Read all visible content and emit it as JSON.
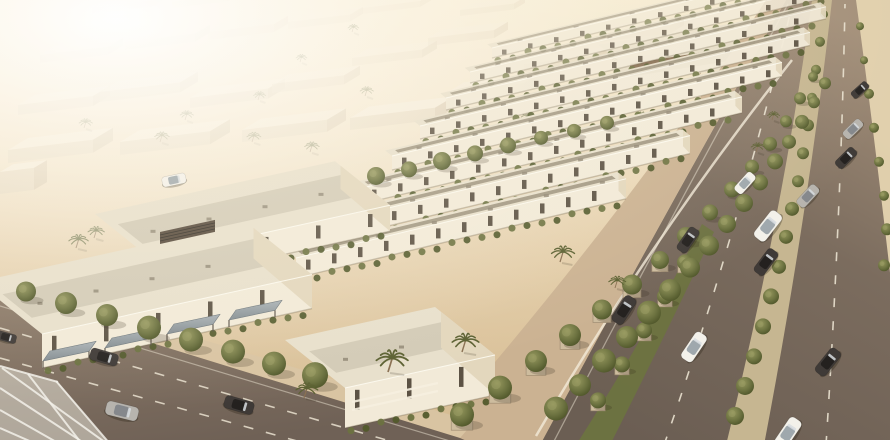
{
  "canvas": {
    "w": 890,
    "h": 440
  },
  "palette": {
    "road_dash": "#eae2d0",
    "edge_line": "#e9e1d0",
    "car_white": "#f3f1ea",
    "car_silver": "#b7b4ae",
    "car_dark": "#3f3a37",
    "cabin_white": "#9fa8ad",
    "cabin_silver": "#85888c",
    "cabin_dark": "#24211f",
    "wall": "#f2ead8",
    "end_wall": "#e3d7bd",
    "roof_out": "#e8e0cc",
    "roof_in_row": "#9f9580",
    "roof_in_villa": "#d2c9b5",
    "window": "#4b4134",
    "wood": "#8a6e4c",
    "green_a": "#6c7240",
    "green_b": "#525a2c",
    "planter": "#cdbc9e",
    "planter_edge": "#9f8c72",
    "trunk": "#8a7052",
    "palm": "#5c6132",
    "post": "#5f564c",
    "median_sand": "#c6b691",
    "median_green": "#6d7340",
    "sidewalk_blvd": "#cbb292",
    "sidewalk_street": "#d9c4a2",
    "verge": "#e5d4b0",
    "canopy_fill": "#eceade",
    "canopy_frame": "#f3f1ea",
    "stripe": "#7a5f43",
    "louver": "#55483a",
    "bg_roof": "#efe6d2",
    "bg_wall": "#d8c8aa",
    "bg_side": "#c7b494",
    "club_roof": "#ece2cc",
    "club_wall": "#e6dcc6",
    "club_side": "#d6c7a8"
  },
  "background": {
    "boxes": [
      [
        8,
        150,
        85,
        40,
        13,
        0.95
      ],
      [
        120,
        142,
        90,
        40,
        13,
        0.95
      ],
      [
        242,
        130,
        85,
        38,
        12,
        0.9
      ],
      [
        350,
        118,
        85,
        38,
        12,
        0.88
      ],
      [
        18,
        105,
        75,
        34,
        10,
        0.8
      ],
      [
        100,
        92,
        80,
        36,
        10,
        0.75
      ],
      [
        190,
        98,
        78,
        34,
        10,
        0.78
      ],
      [
        272,
        84,
        72,
        32,
        9,
        0.7
      ],
      [
        40,
        55,
        68,
        30,
        8,
        0.5
      ],
      [
        125,
        42,
        70,
        30,
        8,
        0.45
      ],
      [
        208,
        32,
        66,
        28,
        8,
        0.42
      ],
      [
        288,
        22,
        62,
        26,
        7,
        0.38
      ],
      [
        92,
        8,
        60,
        24,
        6,
        0.3
      ],
      [
        172,
        2,
        56,
        22,
        6,
        0.28
      ],
      [
        352,
        58,
        70,
        30,
        8,
        0.5
      ],
      [
        428,
        38,
        66,
        28,
        8,
        0.45
      ],
      [
        362,
        8,
        58,
        24,
        6,
        0.32
      ],
      [
        448,
        92,
        76,
        32,
        9,
        0.62
      ],
      [
        524,
        64,
        70,
        30,
        8,
        0.55
      ],
      [
        600,
        34,
        70,
        28,
        8,
        0.5
      ],
      [
        0,
        172,
        34,
        26,
        22,
        0.95
      ],
      [
        460,
        10,
        54,
        22,
        6,
        0.3
      ],
      [
        536,
        116,
        80,
        34,
        10,
        0.7
      ]
    ],
    "palms": [
      [
        84,
        128,
        0.55
      ],
      [
        160,
        142,
        0.6
      ],
      [
        252,
        142,
        0.58
      ],
      [
        310,
        152,
        0.6
      ],
      [
        365,
        96,
        0.55
      ],
      [
        428,
        130,
        0.58
      ],
      [
        352,
        32,
        0.45
      ],
      [
        300,
        62,
        0.45
      ],
      [
        480,
        150,
        0.65
      ],
      [
        526,
        122,
        0.55
      ],
      [
        586,
        98,
        0.55
      ],
      [
        640,
        122,
        0.6
      ],
      [
        616,
        64,
        0.45
      ],
      [
        668,
        94,
        0.5
      ],
      [
        700,
        74,
        0.45
      ],
      [
        76,
        248,
        0.8
      ],
      [
        94,
        238,
        0.68
      ],
      [
        185,
        120,
        0.55
      ],
      [
        258,
        100,
        0.5
      ],
      [
        750,
        60,
        0.45
      ]
    ]
  },
  "clubhouse": {
    "boxes": [
      [
        618,
        60,
        150,
        40,
        26
      ],
      [
        760,
        34,
        130,
        34,
        22
      ]
    ]
  },
  "boulevard": {
    "base": "M540,445 Q662,218 786,0 L898,0 L898,445 Z",
    "verge": "M856,0 Q878,162 898,344 L898,0 Z",
    "sidewalk": "M424,445 L540,445 Q662,218 786,0 L766,0 Q636,202 424,445 Z",
    "green_median": "M576,445 Q652,326 702,224 L714,232 Q668,330 610,445 Z",
    "sand_median": "M726,445 Q782,218 812,0 L832,0 Q808,214 764,445 Z",
    "edge_line": "M552,445 Q668,222 788,4",
    "dashes": [
      "M664,445 Q733,248 792,6",
      "M826,445 Q841,212 845,4"
    ],
    "fence": "M536,436 Q650,240 792,60",
    "green_median_planters": [
      [
        598,
        404
      ],
      [
        622,
        368
      ],
      [
        644,
        334
      ],
      [
        665,
        300
      ],
      [
        685,
        266
      ]
    ],
    "sand_median_trees": [
      [
        735,
        420,
        9
      ],
      [
        745,
        390,
        9
      ],
      [
        754,
        360,
        8
      ],
      [
        763,
        330,
        8
      ],
      [
        771,
        300,
        8
      ],
      [
        779,
        270,
        7
      ],
      [
        786,
        240,
        7
      ],
      [
        792,
        212,
        7
      ],
      [
        798,
        184,
        6
      ],
      [
        803,
        156,
        6
      ],
      [
        808,
        128,
        6
      ],
      [
        812,
        100,
        5
      ],
      [
        816,
        72,
        5
      ],
      [
        820,
        44,
        5
      ],
      [
        824,
        16,
        4
      ]
    ],
    "verge_trees": [
      [
        884,
        268,
        6
      ],
      [
        887,
        232,
        6
      ],
      [
        884,
        198,
        5
      ],
      [
        879,
        164,
        5
      ],
      [
        874,
        130,
        5
      ],
      [
        869,
        96,
        5
      ],
      [
        864,
        62,
        4
      ],
      [
        860,
        28,
        4
      ]
    ],
    "sidewalk_trees": [
      [
        462,
        420,
        12,
        1
      ],
      [
        500,
        393,
        12,
        1
      ],
      [
        536,
        366,
        11,
        1
      ],
      [
        570,
        340,
        11,
        1
      ],
      [
        602,
        314,
        10,
        1
      ],
      [
        632,
        289,
        10,
        1
      ],
      [
        660,
        264,
        9,
        1
      ],
      [
        686,
        240,
        9,
        0
      ],
      [
        710,
        216,
        8,
        0
      ],
      [
        732,
        193,
        8,
        0
      ],
      [
        752,
        170,
        7,
        0
      ],
      [
        770,
        147,
        7,
        0
      ],
      [
        786,
        124,
        6,
        0
      ],
      [
        800,
        101,
        6,
        0
      ],
      [
        813,
        79,
        5,
        0
      ]
    ],
    "frontyard_trees": [
      [
        556,
        414,
        12
      ],
      [
        580,
        390,
        11
      ],
      [
        604,
        366,
        12
      ],
      [
        627,
        342,
        11
      ],
      [
        649,
        318,
        12
      ],
      [
        670,
        295,
        11
      ],
      [
        690,
        272,
        10
      ],
      [
        709,
        250,
        10
      ],
      [
        727,
        228,
        9
      ],
      [
        744,
        207,
        9
      ],
      [
        760,
        186,
        8
      ],
      [
        775,
        165,
        8
      ],
      [
        789,
        145,
        7
      ],
      [
        802,
        125,
        7
      ],
      [
        814,
        105,
        6
      ],
      [
        825,
        86,
        6
      ]
    ]
  },
  "street": {
    "road": "M0,296 L460,438 L476,445 L0,445 Z",
    "sidewalk": "M0,278 L474,422 L460,438 L0,296 Z",
    "edge_line": "M0,306 L450,441",
    "dashes": [
      "M0,328 L414,448",
      "M0,358 L322,448"
    ],
    "trees": [
      [
        26,
        296,
        10
      ],
      [
        66,
        308,
        11
      ],
      [
        107,
        320,
        11
      ],
      [
        149,
        333,
        12
      ],
      [
        191,
        345,
        12
      ],
      [
        233,
        357,
        12
      ],
      [
        274,
        369,
        12
      ],
      [
        315,
        381,
        13
      ]
    ]
  },
  "rows": {
    "bars": [
      [
        492,
        48,
        340,
        10,
        9,
        0.72
      ],
      [
        470,
        72,
        360,
        11,
        10,
        0.82
      ],
      [
        446,
        98,
        380,
        12,
        11,
        0.9
      ],
      [
        420,
        126,
        390,
        13,
        12,
        0.96
      ],
      [
        392,
        156,
        390,
        14,
        13,
        1
      ],
      [
        362,
        188,
        380,
        16,
        14,
        1
      ],
      [
        330,
        222,
        360,
        18,
        15,
        1
      ],
      [
        296,
        258,
        330,
        20,
        16,
        1
      ]
    ]
  },
  "garden_trees": [
    [
      310,
      196,
      8
    ],
    [
      343,
      188,
      8
    ],
    [
      376,
      180,
      9
    ],
    [
      409,
      173,
      8
    ],
    [
      442,
      165,
      9
    ],
    [
      475,
      157,
      8
    ],
    [
      508,
      149,
      8
    ],
    [
      541,
      141,
      7
    ],
    [
      574,
      134,
      7
    ],
    [
      607,
      126,
      7
    ]
  ],
  "villas": {
    "blocks": [
      [
        150,
        258,
        240,
        110,
        26
      ],
      [
        42,
        334,
        270,
        130,
        34
      ],
      [
        345,
        388,
        150,
        120,
        40
      ]
    ],
    "awnings": [
      [
        50,
        351,
        46
      ],
      [
        112,
        338,
        46
      ],
      [
        174,
        324,
        46
      ],
      [
        236,
        310,
        46
      ]
    ],
    "louver": [
      160,
      232,
      55,
      12
    ],
    "fence_rails": [
      "M352,402 L438,383",
      "M352,410 L438,391"
    ]
  },
  "palms_fg": [
    [
      462,
      352,
      1.1
    ],
    [
      388,
      372,
      1.3
    ],
    [
      560,
      262,
      0.95
    ],
    [
      304,
      398,
      0.9
    ],
    [
      615,
      288,
      0.7
    ],
    [
      756,
      152,
      0.55
    ],
    [
      772,
      120,
      0.5
    ]
  ],
  "cars": [
    [
      104,
      357,
      16,
      "dark",
      0.95
    ],
    [
      122,
      411,
      14,
      "silver",
      1.1
    ],
    [
      239,
      405,
      16,
      "dark",
      1.0
    ],
    [
      6,
      337,
      15,
      "dark",
      0.7
    ],
    [
      174,
      180,
      -12,
      "white",
      0.8
    ],
    [
      688,
      240,
      -55,
      "dark",
      0.9
    ],
    [
      624,
      310,
      -57,
      "dark",
      1.0
    ],
    [
      745,
      183,
      -48,
      "white",
      0.8
    ],
    [
      768,
      226,
      -52,
      "white",
      1.1
    ],
    [
      766,
      262,
      -53,
      "dark",
      0.95
    ],
    [
      808,
      196,
      -47,
      "silver",
      0.85
    ],
    [
      846,
      158,
      -45,
      "dark",
      0.8
    ],
    [
      853,
      129,
      -44,
      "silver",
      0.75
    ],
    [
      694,
      347,
      -56,
      "white",
      1.05
    ],
    [
      828,
      362,
      -51,
      "dark",
      1.0
    ],
    [
      788,
      433,
      -56,
      "white",
      1.1
    ],
    [
      860,
      90,
      -42,
      "dark",
      0.65
    ]
  ],
  "glass_canopy": {
    "roof": "M0,366 L58,382 L110,445 L0,445 Z",
    "beams": [
      "M2,368 L106,443",
      "M0,388 L84,443",
      "M0,410 L58,443",
      "M0,428 L34,443",
      "M56,381 L110,444",
      "M28,374 L82,444",
      "M0,366 L58,382"
    ]
  }
}
